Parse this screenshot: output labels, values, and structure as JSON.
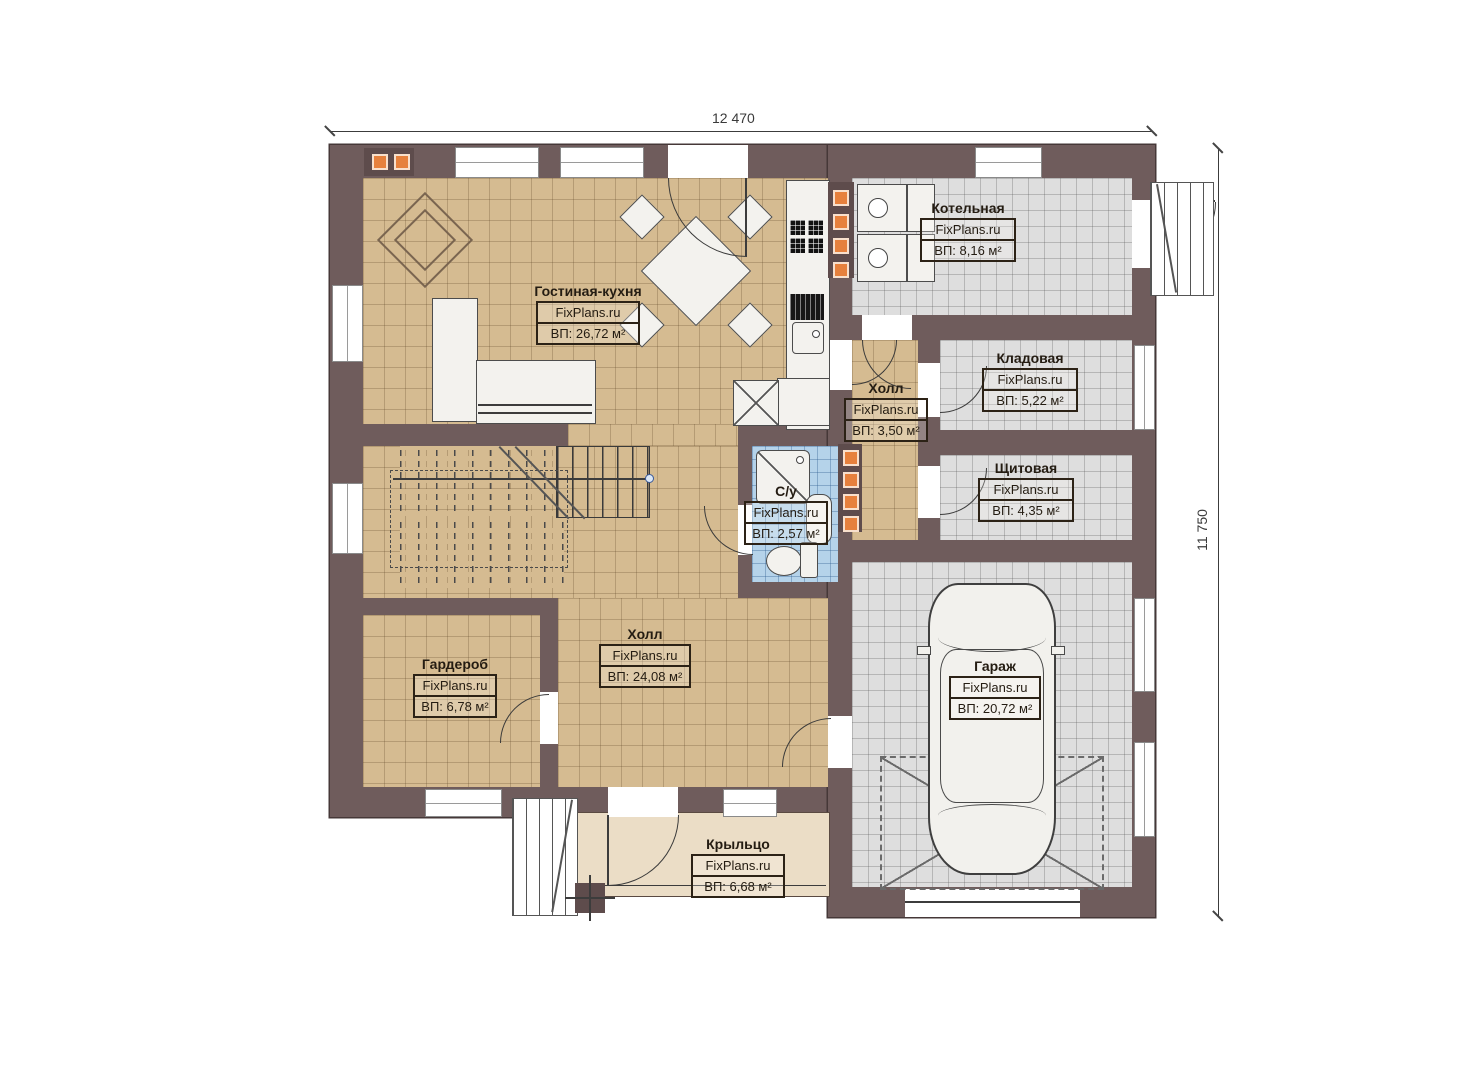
{
  "dims": {
    "top": "12 470",
    "right": "11 750"
  },
  "brand": "FixPlans.ru",
  "rooms": [
    {
      "name": "Гостиная-кухня",
      "brand": "FixPlans.ru",
      "area": "ВП: 26,72 м²"
    },
    {
      "name": "Котельная",
      "brand": "FixPlans.ru",
      "area": "ВП: 8,16 м²"
    },
    {
      "name": "Холл",
      "brand": "FixPlans.ru",
      "area": "ВП: 3,50 м²"
    },
    {
      "name": "Кладовая",
      "brand": "FixPlans.ru",
      "area": "ВП: 5,22 м²"
    },
    {
      "name": "Щитовая",
      "brand": "FixPlans.ru",
      "area": "ВП: 4,35 м²"
    },
    {
      "name": "С/у",
      "brand": "FixPlans.ru",
      "area": "ВП: 2,57 м²"
    },
    {
      "name": "Гардероб",
      "brand": "FixPlans.ru",
      "area": "ВП: 6,78 м²"
    },
    {
      "name": "Холл",
      "brand": "FixPlans.ru",
      "area": "ВП: 24,08 м²"
    },
    {
      "name": "Гараж",
      "brand": "FixPlans.ru",
      "area": "ВП: 20,72 м²"
    },
    {
      "name": "Крыльцо",
      "brand": "FixPlans.ru",
      "area": "ВП: 6,68 м²"
    }
  ],
  "colors": {
    "wall": "#6F5C5C",
    "floor_tan": "#D5BB91",
    "floor_gray": "#DEDEDE",
    "floor_blue": "#B5D3EA",
    "floor_porch": "#EBDDC6",
    "vent_orange": "#E6813D"
  }
}
